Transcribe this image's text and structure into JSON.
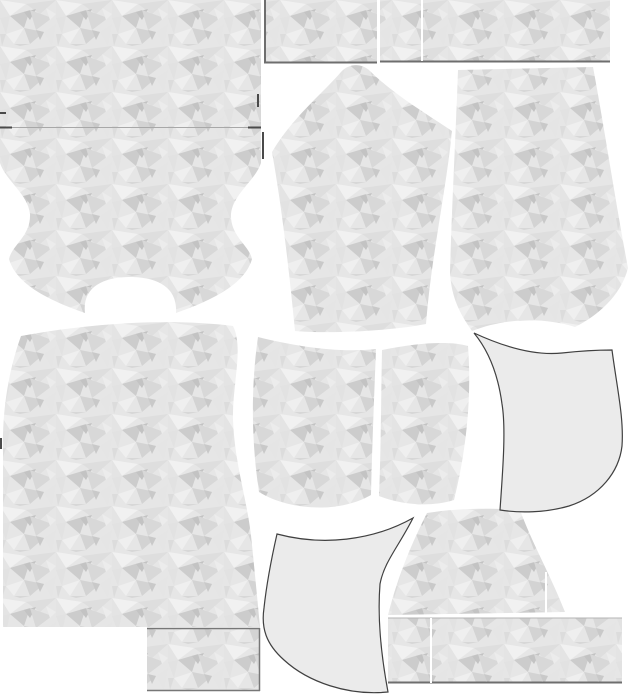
{
  "meta": {
    "title": "sewing-pattern-marker-layout",
    "canvas": {
      "width": 628,
      "height": 700,
      "background": "#ffffff"
    }
  },
  "palette": {
    "texture_base": "#e6e6e6",
    "plain_fill": "#ebebeb",
    "plain_stroke": "#404040",
    "border_dark": "#6e6e6e",
    "border_light": "#a8a8a8",
    "tick_dark": "#4a4a4a",
    "seam_white": "#ffffff"
  },
  "texture": {
    "tile": {
      "width": 56,
      "height": 46
    },
    "polygons": [
      {
        "points": "0,0 26,4 10,16",
        "fill": "#f1f1f1"
      },
      {
        "points": "26,4 56,0 40,14",
        "fill": "#dedede"
      },
      {
        "points": "10,16 30,10 24,28",
        "fill": "#cccccc"
      },
      {
        "points": "24,12 36,9 30,20",
        "fill": "#c3c3c3"
      },
      {
        "points": "30,10 52,18 36,30",
        "fill": "#d8d8d8"
      },
      {
        "points": "0,18 10,16 6,34",
        "fill": "#e2e2e2"
      },
      {
        "points": "6,34 24,28 14,44",
        "fill": "#efefef"
      },
      {
        "points": "24,28 44,32 30,44",
        "fill": "#d3d3d3"
      },
      {
        "points": "44,32 56,24 52,46",
        "fill": "#e5e5e5"
      },
      {
        "points": "36,30 44,32 40,40",
        "fill": "#c9c9c9"
      },
      {
        "points": "0,34 6,34 2,46",
        "fill": "#dcdcdc"
      },
      {
        "points": "14,44 30,44 20,46",
        "fill": "#d7d7d7"
      },
      {
        "points": "46,8 56,14 50,20",
        "fill": "#ececec"
      },
      {
        "points": "0,0 10,16 0,18",
        "fill": "#e4e4e4"
      }
    ]
  },
  "pieces": [
    {
      "name": "panel-top-left",
      "kind": "texture",
      "shape": "rect",
      "x": 0,
      "y": 0,
      "w": 261,
      "h": 127
    },
    {
      "name": "panel-top-middle",
      "kind": "texture",
      "shape": "rect",
      "x": 264,
      "y": 0,
      "w": 113,
      "h": 63
    },
    {
      "name": "panel-top-right",
      "kind": "texture",
      "shape": "rect",
      "x": 380,
      "y": 0,
      "w": 230,
      "h": 62
    },
    {
      "name": "yoke-panel",
      "kind": "texture",
      "shape": "path",
      "d": "M0,128 L261,128 L261,163 C255,181 233,194 231,214 C230,236 249,245 252,259 C245,284 213,300 176,313 C178,288 158,277 130,277 C102,277 82,288 85,313 C48,300 16,284 9,259 C12,245 31,236 30,214 C28,194 6,181 0,163 Z"
    },
    {
      "name": "sleeve-panel",
      "kind": "texture",
      "shape": "path",
      "d": "M272,152 C292,118 322,94 341,72 C349,63 362,63 370,71 C392,93 425,113 452,131 C446,192 431,258 426,324 C390,331 330,334 295,331 C289,270 282,208 272,152 Z"
    },
    {
      "name": "leg-panel",
      "kind": "texture",
      "shape": "path",
      "d": "M458,70 L593,67 C603,120 616,205 628,268 C621,296 597,316 575,327 C543,317 505,318 472,331 C457,310 451,293 450,272 C452,200 456,130 458,70 Z"
    },
    {
      "name": "bodice-panel",
      "kind": "texture",
      "shape": "path",
      "d": "M21,336 C90,323 170,318 233,326 C244,348 232,385 233,420 C235,468 248,500 252,545 C255,575 258,605 260,627 L3,627 L3,452 C2,412 8,372 21,336 Z"
    },
    {
      "name": "pocket-bag-left",
      "kind": "texture",
      "shape": "path",
      "d": "M258,337 C298,347 340,353 376,349 C374,400 372,450 371,495 C338,514 288,510 259,492 C251,440 251,385 258,337 Z"
    },
    {
      "name": "pocket-bag-right",
      "kind": "texture",
      "shape": "path",
      "d": "M382,350 C420,342 452,341 468,346 C472,398 466,452 454,500 C428,508 399,504 379,496 C381,450 381,398 382,350 Z"
    },
    {
      "name": "gusset-panel",
      "kind": "texture",
      "shape": "path",
      "d": "M427,513 C458,508 492,508 520,510 C532,543 550,574 565,612 L388,615 C399,572 413,541 427,513 Z"
    },
    {
      "name": "panel-bottom-right",
      "kind": "texture",
      "shape": "rect",
      "x": 388,
      "y": 618,
      "w": 234,
      "h": 65
    },
    {
      "name": "panel-bottom-left-strip",
      "kind": "texture",
      "shape": "rect",
      "x": 147,
      "y": 628,
      "w": 113,
      "h": 63
    },
    {
      "name": "pocket-facing-right",
      "kind": "plain",
      "shape": "path",
      "d": "M474,333 C502,346 533,356 562,353 C580,351 598,350 612,350 C617,388 624,418 622,446 C619,472 600,496 569,506 C545,513 519,513 500,510 C503,468 506,428 502,404 C498,374 488,350 474,333 Z"
    },
    {
      "name": "pocket-facing-bottom",
      "kind": "plain",
      "shape": "path",
      "d": "M277,534 C322,546 372,541 413,518 C399,546 384,562 380,584 C377,622 382,660 388,692 C348,696 308,682 284,660 C266,644 261,628 264,608 C267,580 272,556 277,534 Z"
    }
  ],
  "lines": [
    {
      "name": "panel-top-left-bottom-border",
      "x1": 0,
      "y1": 127.5,
      "x2": 261,
      "y2": 127.5,
      "stroke": "#a8a8a8",
      "w": 1
    },
    {
      "name": "notch-dash-left",
      "x1": 0,
      "y1": 127.5,
      "x2": 12,
      "y2": 127.5,
      "stroke": "#4a4a4a",
      "w": 2
    },
    {
      "name": "notch-dash-right",
      "x1": 248,
      "y1": 127.5,
      "x2": 261,
      "y2": 127.5,
      "stroke": "#4a4a4a",
      "w": 2
    },
    {
      "name": "panel-top-middle-left-border",
      "x1": 265,
      "y1": 0,
      "x2": 265,
      "y2": 63,
      "stroke": "#6e6e6e",
      "w": 2
    },
    {
      "name": "panel-top-middle-bottom-border",
      "x1": 264,
      "y1": 62.5,
      "x2": 377,
      "y2": 62.5,
      "stroke": "#6e6e6e",
      "w": 2
    },
    {
      "name": "panel-top-right-bottom-border",
      "x1": 380,
      "y1": 61.5,
      "x2": 610,
      "y2": 61.5,
      "stroke": "#6e6e6e",
      "w": 2
    },
    {
      "name": "panel-top-right-seam",
      "x1": 422,
      "y1": 0,
      "x2": 422,
      "y2": 61,
      "stroke": "#ffffff",
      "w": 2
    },
    {
      "name": "panel-bottom-right-top-border",
      "x1": 388,
      "y1": 618,
      "x2": 622,
      "y2": 618,
      "stroke": "#b5b5b5",
      "w": 1
    },
    {
      "name": "panel-bottom-right-bottom-border",
      "x1": 388,
      "y1": 682.5,
      "x2": 622,
      "y2": 682.5,
      "stroke": "#6e6e6e",
      "w": 2
    },
    {
      "name": "panel-bottom-right-seam",
      "x1": 431,
      "y1": 618,
      "x2": 431,
      "y2": 683,
      "stroke": "#ffffff",
      "w": 2
    },
    {
      "name": "gusset-seam",
      "x1": 546,
      "y1": 572,
      "x2": 546,
      "y2": 614,
      "stroke": "#ffffff",
      "w": 2
    },
    {
      "name": "strip-top-border",
      "x1": 147,
      "y1": 628.5,
      "x2": 260,
      "y2": 628.5,
      "stroke": "#777777",
      "w": 1.5
    },
    {
      "name": "strip-right-border",
      "x1": 259.5,
      "y1": 628,
      "x2": 259.5,
      "y2": 691,
      "stroke": "#777777",
      "w": 1.5
    },
    {
      "name": "strip-bottom-border",
      "x1": 147,
      "y1": 690.5,
      "x2": 260,
      "y2": 690.5,
      "stroke": "#777777",
      "w": 1.5
    },
    {
      "name": "notch-tick-top",
      "x1": 258,
      "y1": 94,
      "x2": 258,
      "y2": 107,
      "stroke": "#4a4a4a",
      "w": 2
    },
    {
      "name": "notch-tick-yoke-right",
      "x1": 263,
      "y1": 132,
      "x2": 263,
      "y2": 159,
      "stroke": "#4a4a4a",
      "w": 2
    },
    {
      "name": "notch-tick-left-edge",
      "x1": 0,
      "y1": 113,
      "x2": 6,
      "y2": 113,
      "stroke": "#4a4a4a",
      "w": 2
    },
    {
      "name": "notch-tick-bodice-left",
      "x1": 1,
      "y1": 438,
      "x2": 1,
      "y2": 449,
      "stroke": "#4a4a4a",
      "w": 2
    }
  ]
}
